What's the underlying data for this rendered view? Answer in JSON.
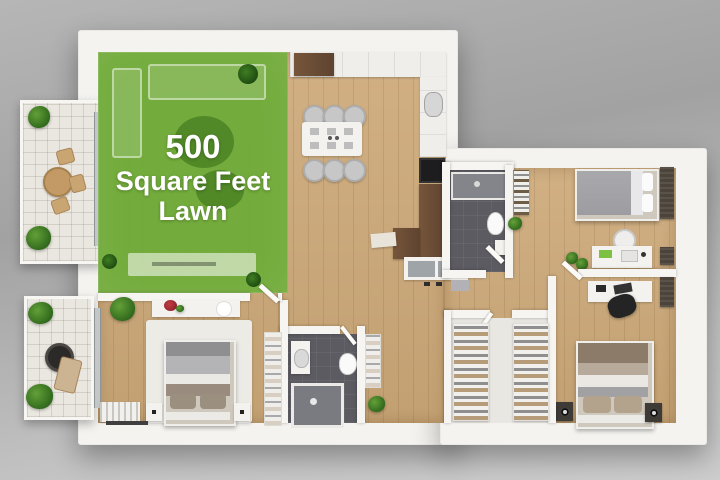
{
  "overlay": {
    "line1": "500",
    "line2": "Square Feet",
    "line3": "Lawn"
  },
  "colors": {
    "lawn_overlay_green": "#6dac38",
    "lawn_label_text": "#ffffff",
    "wood_floor": "#c9a87d",
    "bathroom_floor": "#5b5b61",
    "walls_white": "#f4f3f0",
    "dark_wood_cabinets": "#6d4e34",
    "background_gray": "#adadad"
  },
  "scene": {
    "type": "3d-floor-plan-render",
    "depicted_areas": [
      "living room with green lawn overlay",
      "kitchen and dining area",
      "bedroom top-right",
      "bedroom bottom-right",
      "bedroom bottom-left",
      "bathroom top-center",
      "bathroom bottom-center",
      "walk-in closet",
      "upper-left balcony with table and chairs",
      "lower-left balcony with fire pit and lounge chair",
      "hallway"
    ]
  }
}
